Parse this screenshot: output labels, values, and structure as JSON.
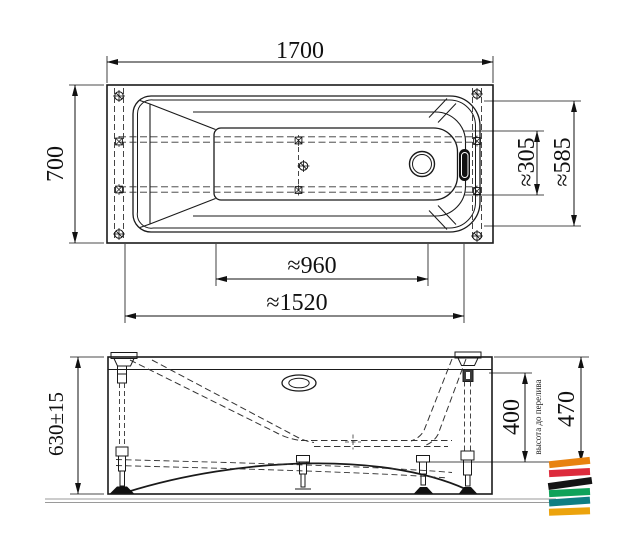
{
  "dims": {
    "top_length": "1700",
    "top_width": "700",
    "overflow_offset": "≈305",
    "drain_overflow_span": "≈585",
    "inner_bottom_length": "≈960",
    "outer_bottom_length": "≈1520",
    "side_height": "630±15",
    "overflow_height": "400",
    "overflow_height_note": "высота до перелива",
    "inner_depth": "470"
  },
  "logo": {
    "stripes": [
      {
        "name": "orange",
        "color": "#E8820F"
      },
      {
        "name": "red",
        "color": "#DD2B3C"
      },
      {
        "name": "black",
        "color": "#141414"
      },
      {
        "name": "green",
        "color": "#0FA25A"
      },
      {
        "name": "teal",
        "color": "#0F7E82"
      },
      {
        "name": "amber",
        "color": "#ECA30D"
      }
    ]
  }
}
